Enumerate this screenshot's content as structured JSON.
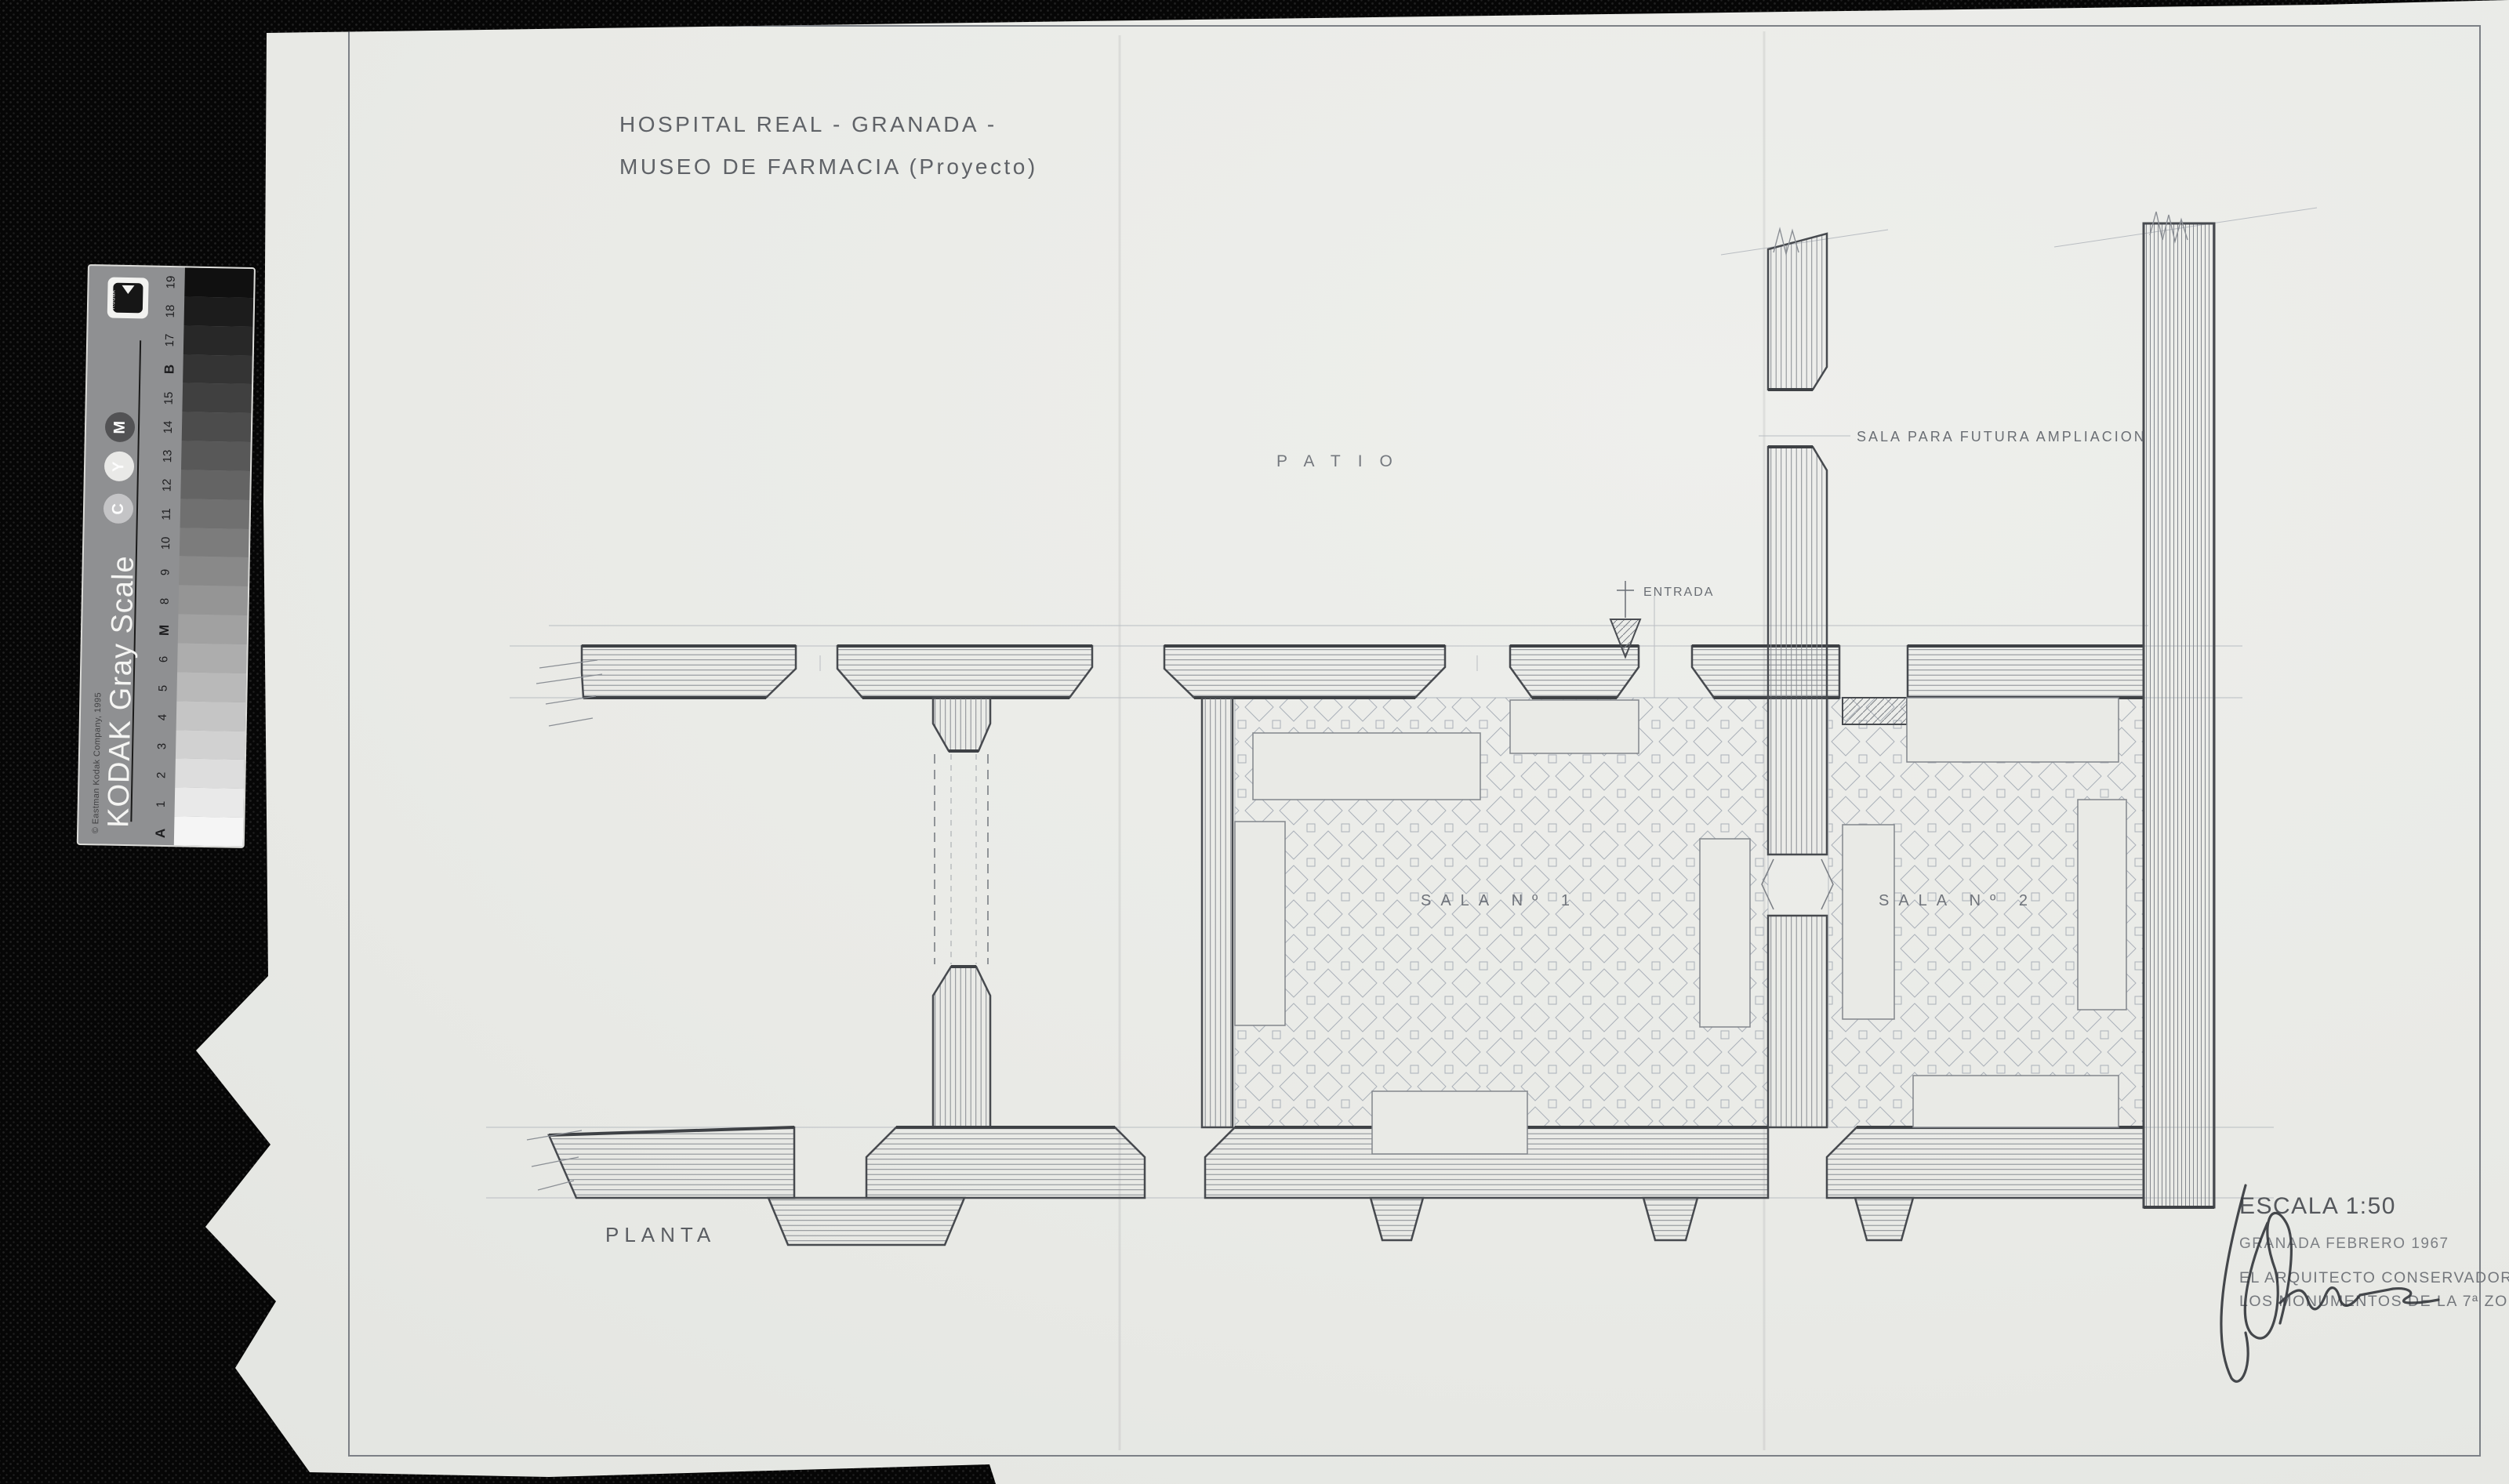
{
  "sheet": {
    "title_line1": "HOSPITAL REAL - GRANADA -",
    "title_line2": "MUSEO DE FARMACIA (Proyecto)",
    "plan_caption": "PLANTA",
    "labels": {
      "patio": "PATIO",
      "future_hall": "SALA PARA FUTURA AMPLIACION",
      "entrance": "ENTRADA",
      "room1": "SALA Nº 1",
      "room2": "SALA Nº 2"
    },
    "title_block": {
      "scale": "ESCALA 1:50",
      "place_date": "GRANADA FEBRERO 1967",
      "signer_line1": "EL ARQUITECTO CONSERVADOR DE",
      "signer_line2": "LOS MONUMENTOS DE LA 7ª ZONA"
    }
  },
  "gray_scale_card": {
    "brand": "Kodak",
    "product_name": "KODAK Gray Scale",
    "copyright": "© Eastman Kodak Company, 1995",
    "color_dots": [
      "M",
      "Y",
      "C"
    ],
    "step_labels_top_to_bottom": [
      "19",
      "18",
      "17",
      "B",
      "15",
      "14",
      "13",
      "12",
      "11",
      "10",
      "9",
      "8",
      "M",
      "6",
      "5",
      "4",
      "3",
      "2",
      "1",
      "A"
    ]
  },
  "colors": {
    "paper": "#e9eae6",
    "ink_dark": "#44474c",
    "pencil_light": "#878b91",
    "tile_line": "#aab0b8",
    "background_cloth": "#060606"
  }
}
